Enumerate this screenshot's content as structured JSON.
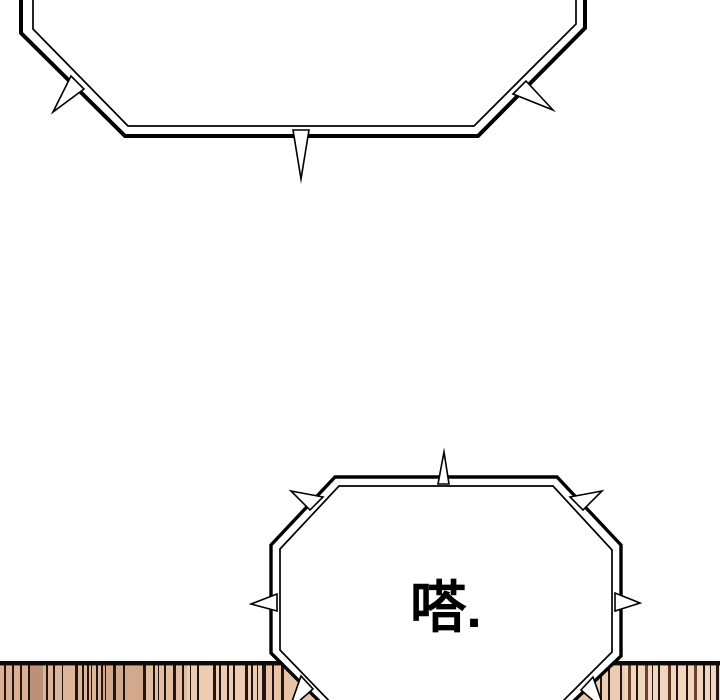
{
  "scene": {
    "type": "comic-panel",
    "background_color": "#ffffff",
    "ink_color": "#000000"
  },
  "bubbles": {
    "top": {
      "style": "spiked-double-outline",
      "text": ""
    },
    "bottom": {
      "style": "spiked-double-outline",
      "text": "嗒."
    }
  },
  "floor": {
    "top_border_color": "#0c0906",
    "base_color": "#e6c0a4",
    "stripe_color": "#221410",
    "shades": [
      {
        "x": 0,
        "w": 30,
        "c": "#dcb193"
      },
      {
        "x": 30,
        "w": 13,
        "c": "#bd9175"
      },
      {
        "x": 43,
        "w": 58,
        "c": "#ddb598"
      },
      {
        "x": 101,
        "w": 42,
        "c": "#d2a98c"
      },
      {
        "x": 143,
        "w": 44,
        "c": "#e3bda1"
      },
      {
        "x": 187,
        "w": 78,
        "c": "#eccdb4"
      },
      {
        "x": 265,
        "w": 330,
        "c": "#e8c3a8"
      },
      {
        "x": 595,
        "w": 30,
        "c": "#eccdb4"
      },
      {
        "x": 625,
        "w": 95,
        "c": "#f1d5bf"
      }
    ],
    "stripes": [
      {
        "x": 4,
        "w": 2
      },
      {
        "x": 12,
        "w": 2
      },
      {
        "x": 20,
        "w": 2
      },
      {
        "x": 28,
        "w": 2
      },
      {
        "x": 46,
        "w": 2
      },
      {
        "x": 53,
        "w": 2
      },
      {
        "x": 62,
        "w": 1
      },
      {
        "x": 75,
        "w": 3
      },
      {
        "x": 82,
        "w": 2
      },
      {
        "x": 87,
        "w": 2
      },
      {
        "x": 91,
        "w": 1
      },
      {
        "x": 96,
        "w": 2
      },
      {
        "x": 101,
        "w": 2
      },
      {
        "x": 105,
        "w": 1
      },
      {
        "x": 113,
        "w": 3
      },
      {
        "x": 123,
        "w": 2
      },
      {
        "x": 143,
        "w": 3
      },
      {
        "x": 153,
        "w": 2
      },
      {
        "x": 158,
        "w": 1
      },
      {
        "x": 164,
        "w": 2
      },
      {
        "x": 173,
        "w": 3
      },
      {
        "x": 182,
        "w": 2
      },
      {
        "x": 190,
        "w": 1
      },
      {
        "x": 197,
        "w": 2
      },
      {
        "x": 213,
        "w": 3
      },
      {
        "x": 219,
        "w": 2
      },
      {
        "x": 227,
        "w": 2
      },
      {
        "x": 233,
        "w": 2
      },
      {
        "x": 245,
        "w": 3
      },
      {
        "x": 251,
        "w": 2
      },
      {
        "x": 257,
        "w": 1
      },
      {
        "x": 262,
        "w": 4
      },
      {
        "x": 272,
        "w": 2
      },
      {
        "x": 281,
        "w": 3
      },
      {
        "x": 600,
        "w": 2
      },
      {
        "x": 608,
        "w": 2
      },
      {
        "x": 620,
        "w": 2
      },
      {
        "x": 628,
        "w": 3,
        "c": "#6b4130"
      },
      {
        "x": 636,
        "w": 2
      },
      {
        "x": 645,
        "w": 3,
        "c": "#6b4130"
      },
      {
        "x": 652,
        "w": 1
      },
      {
        "x": 658,
        "w": 2
      },
      {
        "x": 668,
        "w": 3,
        "c": "#5d3522"
      },
      {
        "x": 676,
        "w": 2
      },
      {
        "x": 686,
        "w": 2
      },
      {
        "x": 694,
        "w": 3,
        "c": "#6b4130"
      },
      {
        "x": 703,
        "w": 2
      },
      {
        "x": 710,
        "w": 1
      },
      {
        "x": 716,
        "w": 3
      }
    ]
  }
}
